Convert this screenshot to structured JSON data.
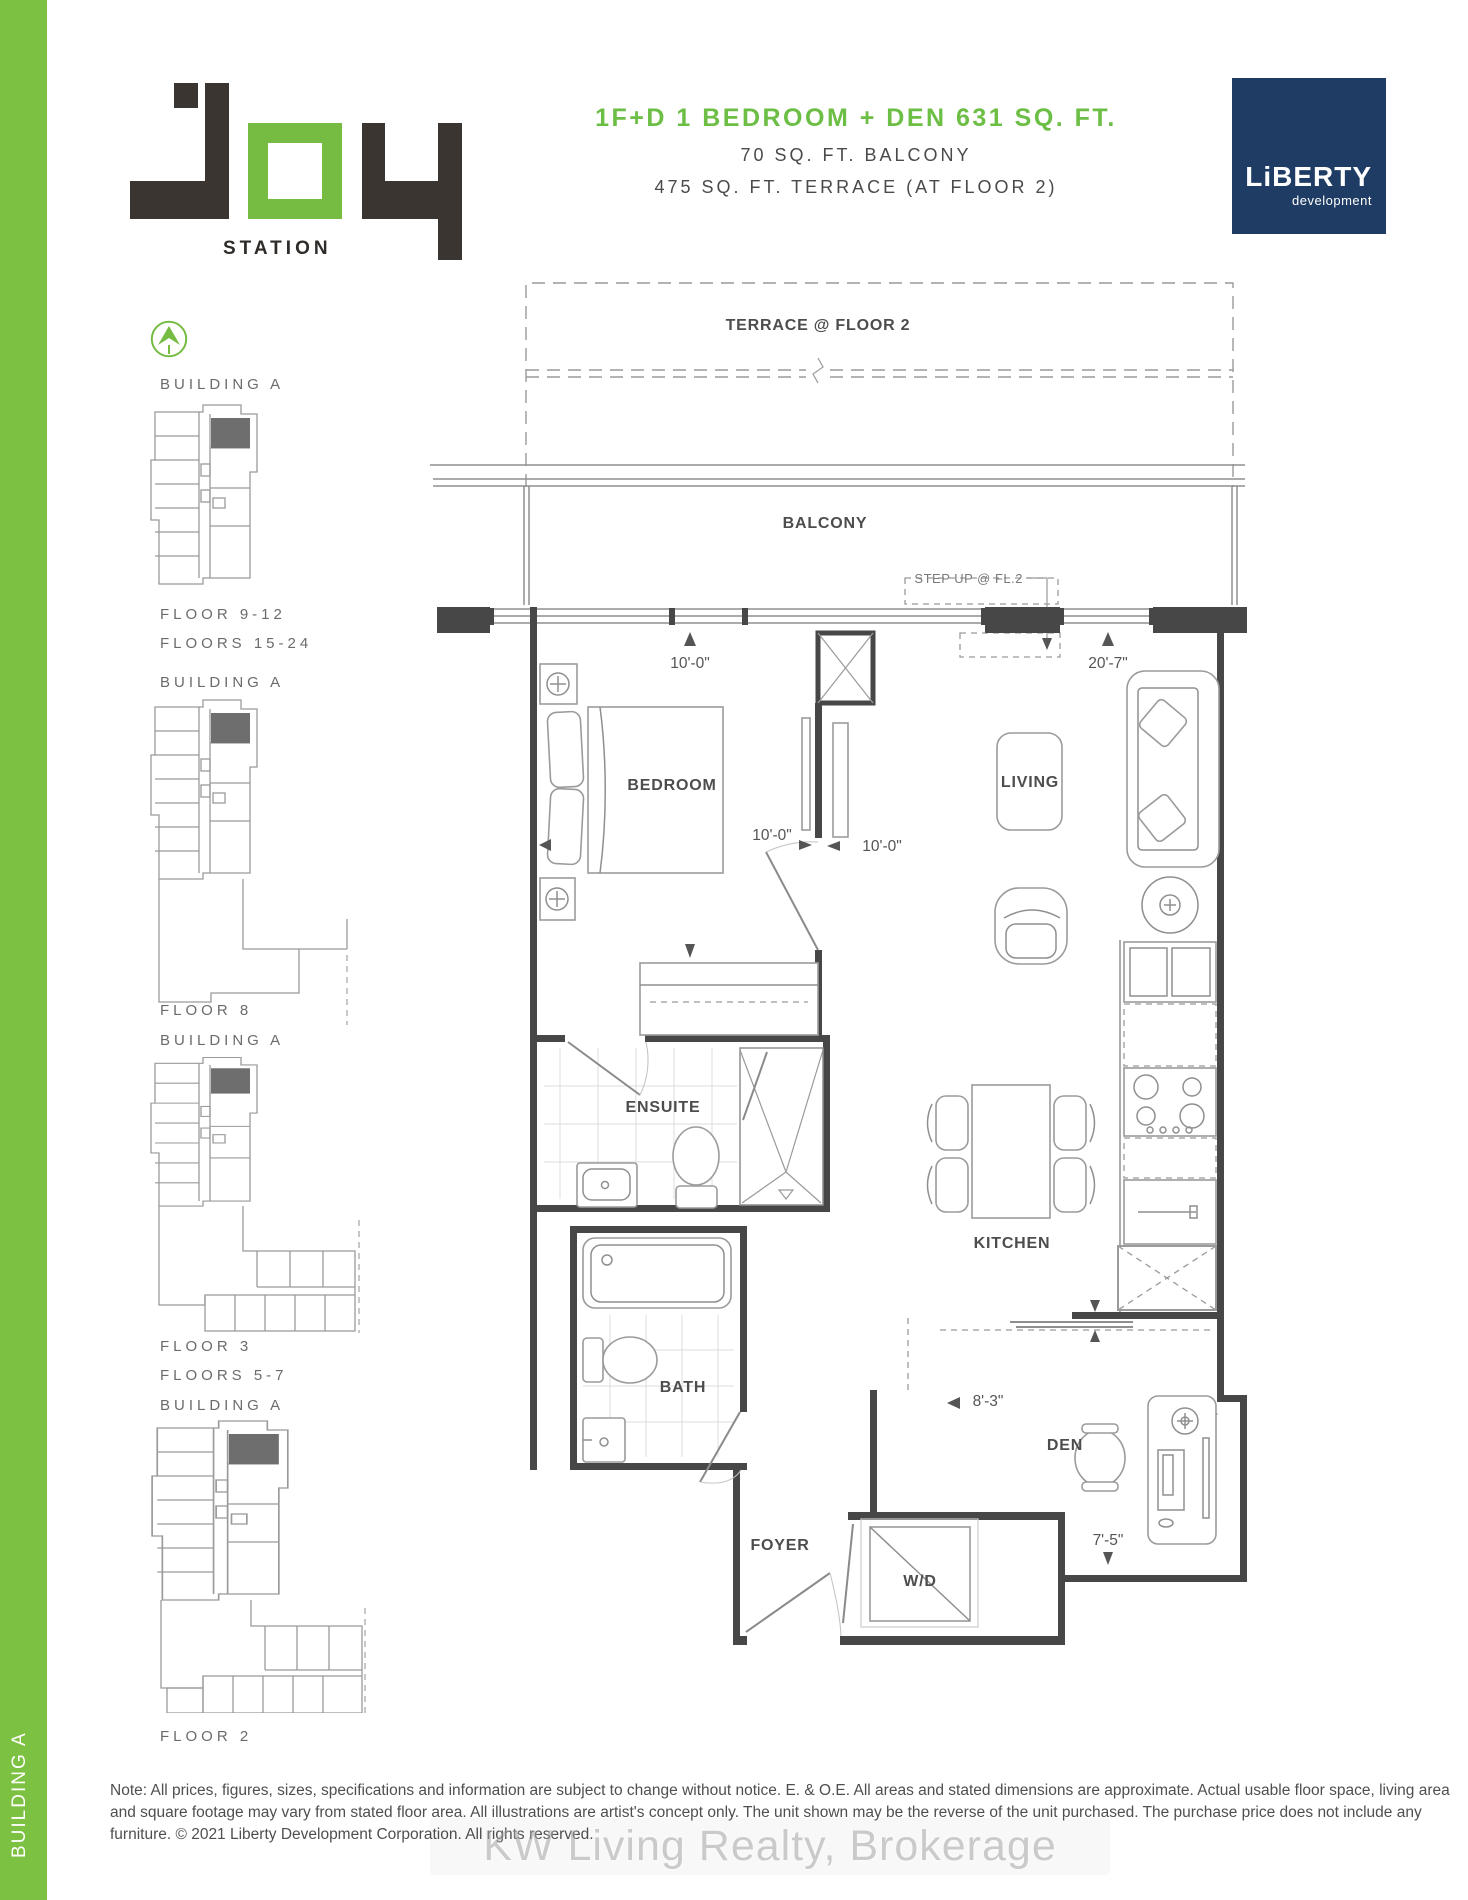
{
  "header": {
    "title": "1F+D 1 BEDROOM + DEN 631 SQ. FT.",
    "subtitle1": "70 SQ. FT. BALCONY",
    "subtitle2": "475 SQ. FT. TERRACE (AT FLOOR 2)",
    "title_color": "#6CBE45"
  },
  "brand": {
    "station_label": "STATION",
    "liberty_name": "LiBERTY",
    "liberty_sub": "development",
    "navy": "#1E3C64",
    "green": "#76BC43"
  },
  "sidebar": {
    "vertical_label": "BUILDING A"
  },
  "keyplans": [
    {
      "building": "BUILDING A",
      "floors": [
        "FLOOR 9-12",
        "FLOORS 15-24"
      ]
    },
    {
      "building": "BUILDING A",
      "floors": [
        "FLOOR 8"
      ]
    },
    {
      "building": "BUILDING A",
      "floors": [
        "FLOOR 3",
        "FLOORS 5-7"
      ]
    },
    {
      "building": "BUILDING A",
      "floors": [
        "FLOOR 2"
      ]
    }
  ],
  "plan": {
    "rooms": {
      "terrace": "TERRACE @ FLOOR 2",
      "balcony": "BALCONY",
      "bedroom": "BEDROOM",
      "living": "LIVING",
      "ensuite": "ENSUITE",
      "kitchen": "KITCHEN",
      "bath": "BATH",
      "foyer": "FOYER",
      "wd": "W/D",
      "den": "DEN"
    },
    "annotations": {
      "step_up": "STEP UP @ FL.2"
    },
    "dims": {
      "bedroom_width": "10'-0\"",
      "living_width": "20'-7\"",
      "bedroom_depth": "10'-0\"",
      "living_depth": "10'-0\"",
      "hall_len": "8'-3\"",
      "den_width": "7'-5\""
    }
  },
  "footer": {
    "note": "Note: All prices, figures, sizes, specifications and information are subject to change without notice. E. & O.E. All areas and stated dimensions are approximate. Actual usable floor space, living area and square footage may vary from stated floor area. All illustrations are artist's concept only. The unit shown may be the reverse of the unit purchased. The purchase price does not include any furniture. © 2021 Liberty Development Corporation. All rights reserved.",
    "watermark": "KW Living Realty, Brokerage"
  }
}
